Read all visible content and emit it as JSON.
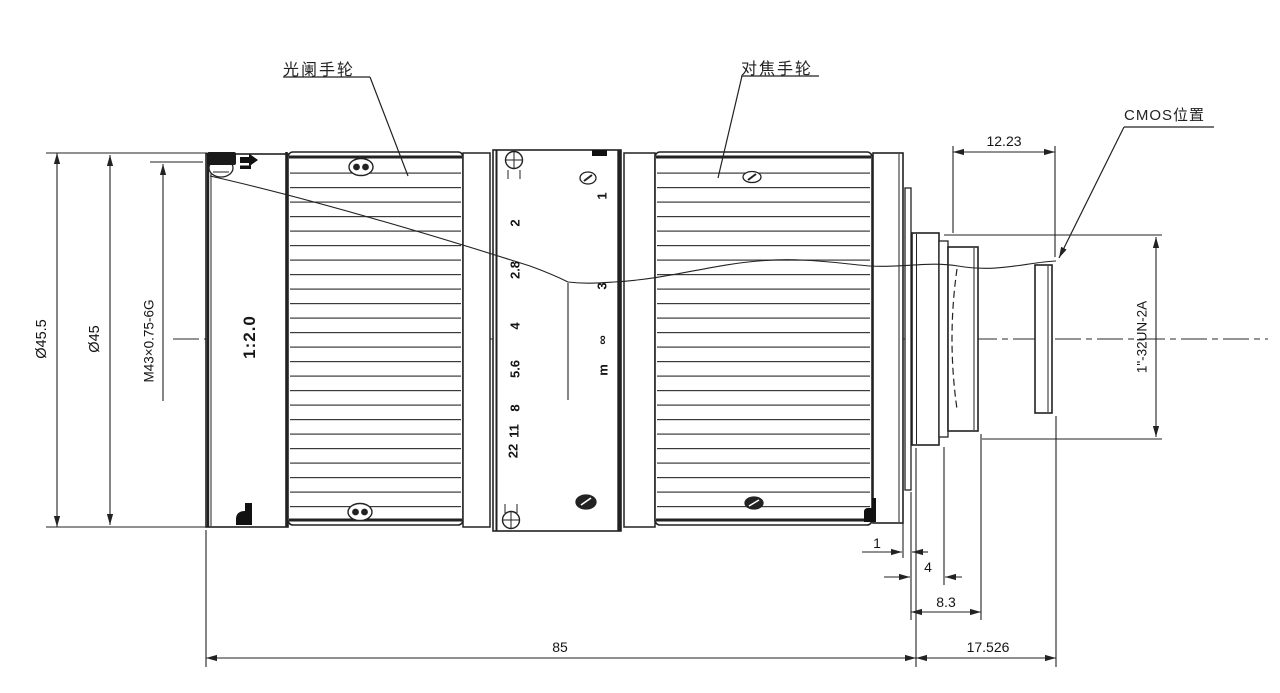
{
  "colors": {
    "line": "#222222",
    "background": "#ffffff",
    "text": "#111111"
  },
  "callouts": {
    "aperture_wheel": "光阑手轮",
    "focus_wheel": "对焦手轮",
    "cmos_position": "CMOS位置"
  },
  "markings": {
    "aperture_ratio": "1:2.0",
    "front_thread": "M43×0.75-6G",
    "mount_thread": "1\"-32UN-2A"
  },
  "aperture_scale": {
    "values": [
      "2",
      "2.8",
      "4",
      "5.6",
      "8",
      "11",
      "22"
    ]
  },
  "focus_scale": {
    "values": [
      "1",
      "3",
      "∞"
    ],
    "unit": "m"
  },
  "dimensions": {
    "outer_diameter": "Ø45.5",
    "barrel_diameter": "Ø45",
    "body_length": "85",
    "rear_length": "17.526",
    "cmos_offset": "12.23",
    "gap": "1",
    "step": "4",
    "mount_length": "8.3"
  }
}
